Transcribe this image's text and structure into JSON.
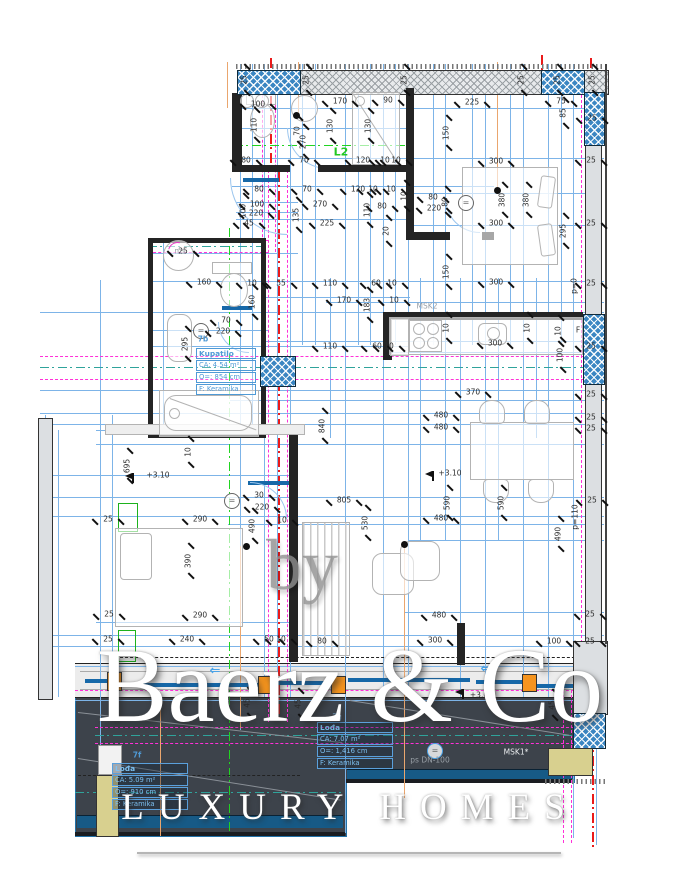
{
  "watermark": {
    "by": "by",
    "brand": "Baerz & Co",
    "tagline": "LUXURY HOMES"
  },
  "rooms": {
    "bathroom": {
      "id": "7b",
      "name": "Kupatilo",
      "area": "CA: 4.54 m²",
      "perimeter": "O=: 854 cm",
      "floor": "F: Keramika"
    },
    "loggia": {
      "id": "7g",
      "name": "Lođa",
      "area": "CA: 7.07 m²",
      "perimeter": "O=: 1,416 cm",
      "floor": "F: Keramika"
    },
    "terrace": {
      "id": "7f",
      "name": "Lođa",
      "area": "CA: 5.09 m²",
      "perimeter": "O=: 910 cm",
      "floor": "F: Keramika"
    }
  },
  "colors": {
    "dimension_line": "#7db4e8",
    "axis_magenta": "#ff30d8",
    "axis_teal": "#2fa39b",
    "axis_green": "#21d421",
    "axis_red": "#ea1a1a",
    "pendant_orange": "#eaa66e",
    "window_marker": "#f5941e",
    "terrace_dark": "#3d434b",
    "wall_hatch_blue": "#3b86c2",
    "label_blue": "#4f9ad6",
    "planter_yellow": "#d8d08f"
  },
  "annotations": [
    [
      "100",
      258,
      104
    ],
    [
      "170",
      340,
      101
    ],
    [
      "90",
      388,
      100
    ],
    [
      "225",
      472,
      102
    ],
    [
      "75",
      561,
      101
    ],
    [
      "85",
      563,
      113,
      1
    ],
    [
      "110",
      254,
      125,
      1
    ],
    [
      "130",
      330,
      126,
      1
    ],
    [
      "130",
      368,
      126,
      1
    ],
    [
      "150",
      446,
      133,
      1
    ],
    [
      "70",
      297,
      131,
      1
    ],
    [
      "270",
      303,
      142,
      1
    ],
    [
      "25",
      244,
      80,
      1
    ],
    [
      "25",
      306,
      80,
      1
    ],
    [
      "25",
      404,
      80,
      1
    ],
    [
      "25",
      521,
      80,
      1
    ],
    [
      "25",
      557,
      80,
      1
    ],
    [
      "25",
      592,
      80,
      1
    ],
    [
      "25",
      592,
      118
    ],
    [
      "80",
      246,
      160
    ],
    [
      "70",
      304,
      160
    ],
    [
      "120",
      363,
      160
    ],
    [
      "10",
      385,
      160
    ],
    [
      "10",
      396,
      160
    ],
    [
      "80",
      259,
      189
    ],
    [
      "70",
      307,
      189
    ],
    [
      "120",
      358,
      189
    ],
    [
      "10",
      373,
      189
    ],
    [
      "10",
      391,
      189
    ],
    [
      "100",
      257,
      204
    ],
    [
      "220",
      256,
      213
    ],
    [
      "45",
      249,
      223
    ],
    [
      "100",
      243,
      211,
      1
    ],
    [
      "135",
      296,
      215,
      1
    ],
    [
      "270",
      320,
      204
    ],
    [
      "225",
      327,
      223
    ],
    [
      "110",
      367,
      210,
      1
    ],
    [
      "80",
      382,
      206
    ],
    [
      "20",
      386,
      231,
      1
    ],
    [
      "80",
      433,
      197
    ],
    [
      "220",
      434,
      208
    ],
    [
      "80",
      445,
      202,
      1
    ],
    [
      "10",
      404,
      196,
      1
    ],
    [
      "300",
      496,
      161
    ],
    [
      "380",
      502,
      200,
      1
    ],
    [
      "380",
      526,
      200,
      1
    ],
    [
      "300",
      496,
      223
    ],
    [
      "295",
      563,
      231,
      1
    ],
    [
      "150",
      446,
      272,
      1
    ],
    [
      "300",
      496,
      282
    ],
    [
      "25",
      591,
      160
    ],
    [
      "25",
      591,
      223
    ],
    [
      "25",
      591,
      283
    ],
    [
      "p=0",
      574,
      286,
      1
    ],
    [
      "25",
      183,
      251
    ],
    [
      "160",
      204,
      282
    ],
    [
      "10",
      252,
      283
    ],
    [
      "160",
      252,
      302,
      1
    ],
    [
      "295",
      185,
      344,
      1
    ],
    [
      "70",
      226,
      320
    ],
    [
      "220",
      223,
      331
    ],
    [
      "7b",
      203,
      339,
      0,
      "blue"
    ],
    [
      "55",
      281,
      283
    ],
    [
      "110",
      330,
      283
    ],
    [
      "60",
      376,
      283
    ],
    [
      "10",
      392,
      283
    ],
    [
      "170",
      344,
      300
    ],
    [
      "183",
      367,
      305,
      1
    ],
    [
      "10",
      394,
      300
    ],
    [
      "110",
      330,
      346
    ],
    [
      "60",
      377,
      346
    ],
    [
      "10",
      389,
      346
    ],
    [
      "10",
      446,
      328,
      1
    ],
    [
      "10",
      527,
      328,
      1
    ],
    [
      "10",
      558,
      331,
      1
    ],
    [
      "300",
      495,
      343
    ],
    [
      "100",
      560,
      355,
      1
    ],
    [
      "MSK2",
      427,
      306,
      0,
      "gray"
    ],
    [
      "F",
      578,
      330
    ],
    [
      "370",
      473,
      392
    ],
    [
      "480",
      441,
      415
    ],
    [
      "480",
      441,
      427
    ],
    [
      "840",
      322,
      426,
      1
    ],
    [
      "805",
      344,
      500
    ],
    [
      "530",
      365,
      523,
      1
    ],
    [
      "590",
      447,
      503,
      1
    ],
    [
      "590",
      501,
      503,
      1
    ],
    [
      "480",
      441,
      518
    ],
    [
      "490",
      558,
      534,
      1
    ],
    [
      "p=110",
      575,
      517,
      1
    ],
    [
      "25",
      591,
      346
    ],
    [
      "25",
      591,
      394
    ],
    [
      "25",
      591,
      417
    ],
    [
      "25",
      591,
      428
    ],
    [
      "25",
      592,
      500
    ],
    [
      "+3.10",
      450,
      473
    ],
    [
      "+3.10",
      158,
      475
    ],
    [
      "695",
      127,
      466,
      1
    ],
    [
      "10",
      188,
      452,
      1
    ],
    [
      "30",
      259,
      495
    ],
    [
      "220",
      262,
      507
    ],
    [
      "10",
      282,
      520
    ],
    [
      "490",
      252,
      526,
      1
    ],
    [
      "290",
      200,
      519
    ],
    [
      "25",
      108,
      519
    ],
    [
      "390",
      188,
      561,
      1
    ],
    [
      "290",
      200,
      615
    ],
    [
      "25",
      109,
      614
    ],
    [
      "240",
      187,
      639
    ],
    [
      "25",
      108,
      639
    ],
    [
      "50",
      269,
      639
    ],
    [
      "10",
      281,
      639
    ],
    [
      "80",
      322,
      641
    ],
    [
      "300",
      435,
      640
    ],
    [
      "100",
      554,
      641
    ],
    [
      "25",
      590,
      641
    ],
    [
      "480",
      439,
      615
    ],
    [
      "25",
      590,
      614
    ],
    [
      "45",
      247,
      703,
      1
    ],
    [
      "45",
      298,
      704,
      1
    ],
    [
      "45",
      552,
      705,
      1
    ],
    [
      "+3.0",
      479,
      695
    ],
    [
      "MSK1*",
      516,
      752,
      0,
      "white"
    ],
    [
      "ps DN-100",
      430,
      760,
      0,
      "gray"
    ],
    [
      "7g",
      337,
      717,
      0,
      "ltblue"
    ],
    [
      "7f",
      137,
      755,
      0,
      "blue"
    ],
    [
      "L2",
      341,
      152,
      0,
      "green"
    ],
    [
      "ms",
      180,
      251,
      0,
      "gray"
    ],
    [
      "⇐",
      215,
      671,
      0,
      "arrow"
    ],
    [
      "⇐",
      486,
      669,
      0,
      "arrow"
    ]
  ]
}
